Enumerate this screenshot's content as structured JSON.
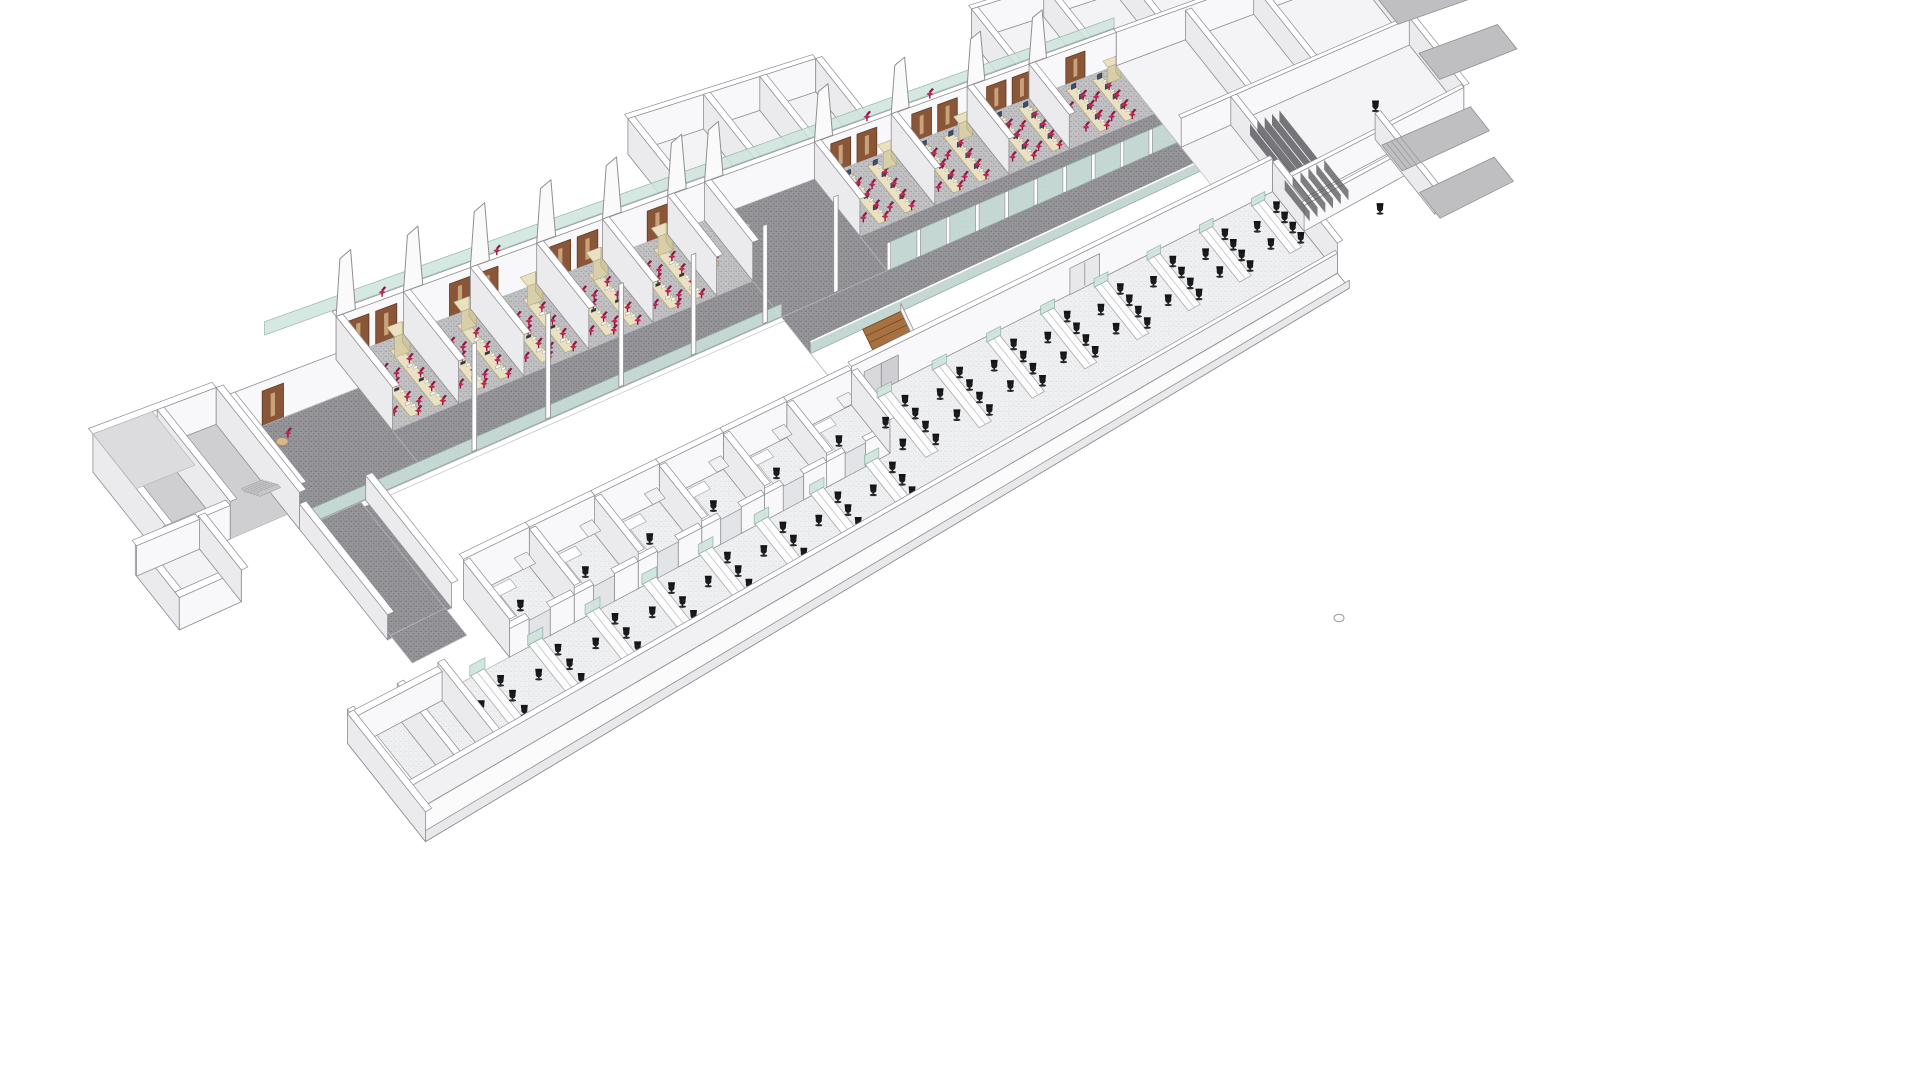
{
  "viewport": {
    "width": 1920,
    "height": 1080,
    "background": "#ffffff",
    "view_type": "axonometric cutaway 3D render of a building floor plan with two diagonal wings"
  },
  "colors": {
    "outline": "#8f8f94",
    "outline_light": "#b9b9bd",
    "wall_face": "#f8f8fa",
    "wall_side": "#ebebee",
    "wall_top": "#ffffff",
    "carpet_dark_base": "#95959a",
    "carpet_dark_dot": "#6f6f74",
    "carpet_lab_base": "#c2c2c5",
    "carpet_lab_dot": "#97979b",
    "floor_office_base": "#eff0f1",
    "floor_office_dot": "#dddedf",
    "floor_room": "#f3f3f5",
    "atrium_white": "#ffffff",
    "glass": "#cfe4dd",
    "glass_edge": "#8fb3a9",
    "door_brown": "#8a5638",
    "door_dark": "#5f3a24",
    "door_inlay": "#c9a27a",
    "wood_stair": "#a9713f",
    "wood_stair_dark": "#6b4423",
    "wood_landing": "#b07a46",
    "bench_cream": "#eae1c2",
    "bench_cream_front": "#d8cfa8",
    "bench_cream_side": "#cfc69e",
    "bench_cream_edge": "#b0a77e",
    "chair_red": "#c5255a",
    "chair_red_dark": "#8f1a3e",
    "chair_black": "#1b1b1d",
    "desk_white": "#fdfdfe",
    "desk_edge": "#a8a8ac",
    "monitor_navy": "#3c4e70",
    "table_tan": "#d8b88a",
    "gray_floor": "#cfcfd2",
    "gray_roof": "#dcdcde",
    "ramp_gray": "#bfbfc2",
    "shelf_dark": "#55555a"
  },
  "lab_wing": {
    "entry": {
      "u0": 115,
      "u1": 250
    },
    "left": {
      "u0": 250,
      "u1": 640,
      "partitions": [
        320,
        390,
        460,
        530,
        600
      ],
      "doors": [
        262,
        291,
        368,
        397,
        474,
        503,
        578
      ],
      "bench_offsets": [
        14,
        40
      ],
      "chairs_per_bench": 4
    },
    "hall": {
      "u0": 640,
      "u1": 760
    },
    "right": {
      "u0": 760,
      "u1": 1100,
      "partitions": [
        845,
        930,
        1015
      ],
      "doors": [
        778,
        807,
        868,
        897,
        952,
        981,
        1042
      ],
      "bench_offsets": [
        16,
        46
      ]
    },
    "fins": [
      250,
      320,
      390,
      460,
      530,
      600,
      640,
      760,
      845,
      930,
      1000
    ],
    "roof_chairs": [
      300,
      420,
      540,
      820,
      890
    ],
    "posts": [
      300,
      380,
      460,
      540,
      620,
      700
    ]
  },
  "back_rooms": [
    {
      "u0": 620,
      "u1": 820,
      "walls": [
        700,
        760
      ]
    },
    {
      "u0": 990,
      "u1": 1240,
      "walls": [
        1070,
        1150
      ]
    }
  ],
  "right_block": {
    "u0": 1100,
    "u1": 1380,
    "cross": [
      1180,
      1260
    ],
    "shelf_lines": 5
  },
  "office_wing": {
    "u0": 20,
    "u1": 1150,
    "open_back_u0": 640,
    "cell_partitions": [
      200,
      273,
      346,
      419,
      492,
      565,
      640
    ],
    "rows_right": {
      "us": [
        660,
        725,
        790,
        855,
        920,
        985,
        1050,
        1115
      ],
      "v0": 245,
      "v1": 345,
      "chairs_right": 4,
      "chairs_left": 2
    },
    "rows_left": {
      "us": [
        150,
        215,
        280,
        345,
        410,
        475,
        540,
        605
      ],
      "v0": 315,
      "v1": 390,
      "chairs_right": 3,
      "chairs_left": 1
    },
    "sliding_door_u": 655,
    "double_door_u": 900,
    "end_block": {
      "u0": 1150,
      "u1": 1280
    },
    "left_room_walls": [
      20,
      75,
      120
    ]
  },
  "bridge": {
    "u0": 115,
    "u1": 185,
    "v0": 80,
    "v1": 228,
    "door_u": 150
  },
  "left_block": {
    "main": {
      "u0": -10,
      "u1": 115,
      "v0": -60,
      "v1": 60
    },
    "annex": {
      "u0": -40,
      "u1": 25,
      "v0": 55,
      "v1": 125
    },
    "stair": {
      "u": 95,
      "v": 15,
      "steps": 6
    }
  },
  "stairs": {
    "u0": 700,
    "u1": 744,
    "v_start": 140,
    "v_land": 196,
    "v_land2": 226,
    "flight2_u": 656,
    "treads": 8
  },
  "stray_circle": {
    "cx": 1339,
    "cy": 618,
    "rx": 5,
    "ry": 3.8
  }
}
